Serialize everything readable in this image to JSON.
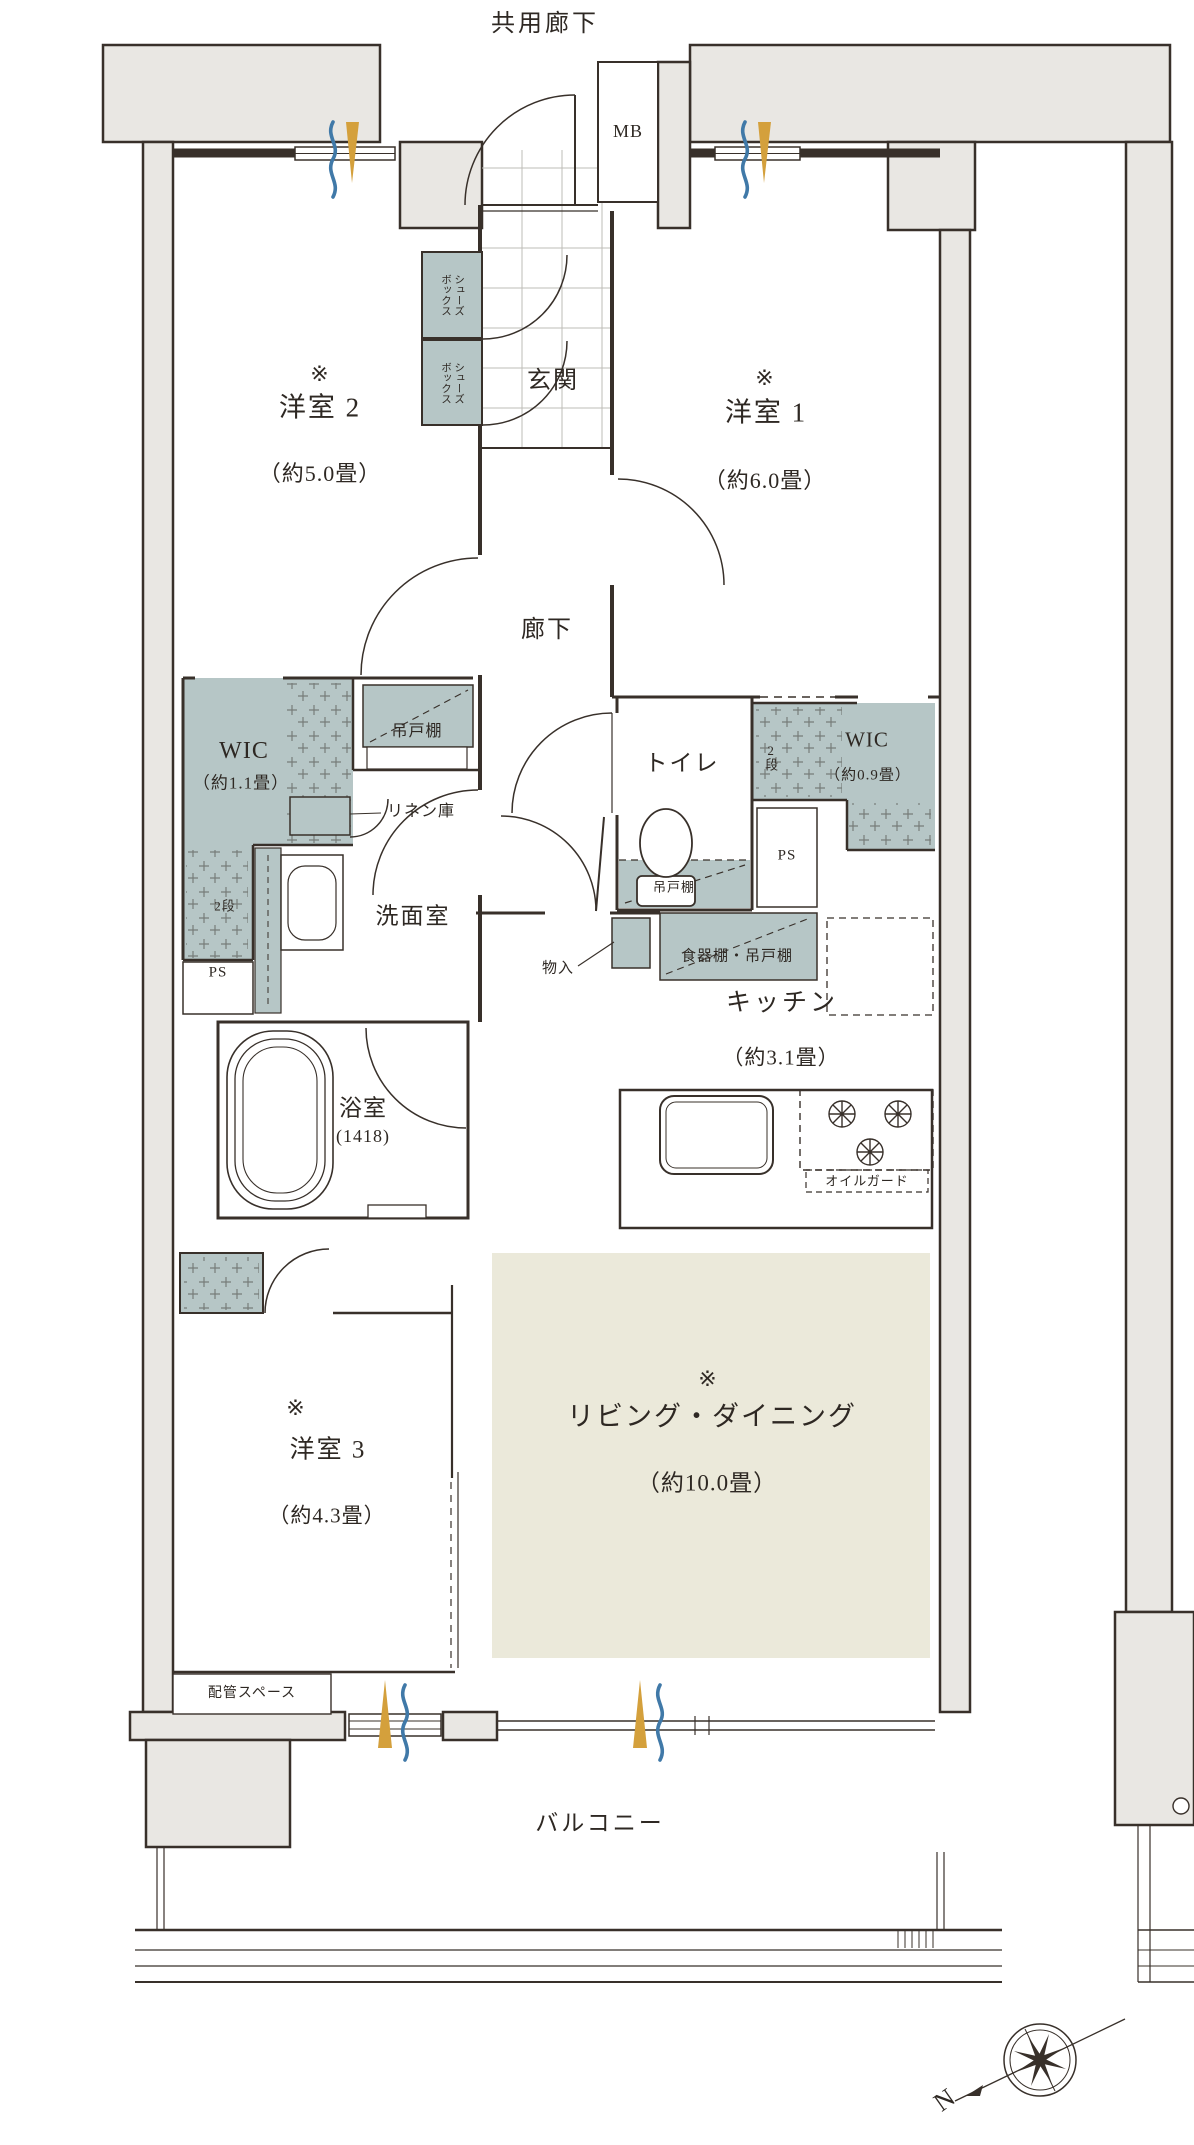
{
  "header": {
    "top_label": "共用廊下"
  },
  "rooms": {
    "yoshitsu2": {
      "mark": "※",
      "name": "洋室 2",
      "size": "（約5.0畳）"
    },
    "yoshitsu1": {
      "mark": "※",
      "name": "洋室 1",
      "size": "（約6.0畳）"
    },
    "yoshitsu3": {
      "mark": "※",
      "name": "洋室 3",
      "size": "（約4.3畳）"
    },
    "living": {
      "mark": "※",
      "name": "リビング・ダイニング",
      "size": "（約10.0畳）"
    },
    "kitchen": {
      "name": "キッチン",
      "size": "（約3.1畳）"
    },
    "genkan": {
      "name": "玄関"
    },
    "rouka": {
      "name": "廊下"
    },
    "toilet": {
      "name": "トイレ"
    },
    "senmen": {
      "name": "洗面室"
    },
    "bath": {
      "name": "浴室",
      "size": "(1418)"
    },
    "balcony": {
      "name": "バルコニー"
    },
    "wic_left": {
      "name": "WIC",
      "size": "（約1.1畳）"
    },
    "wic_right": {
      "name": "WIC",
      "size": "（約0.9畳）"
    }
  },
  "storage": {
    "shoes_line1": "シューズ",
    "shoes_line2": "ボックス",
    "tsuridana": "吊戸棚",
    "linen": "リネン庫",
    "nidan": "2段",
    "shokkidana": "食器棚・吊戸棚",
    "mononire": "物入",
    "ps": "PS",
    "mb": "MB",
    "oil_guard": "オイルガード",
    "haikan": "配管スペース"
  },
  "compass": {
    "north": "N"
  },
  "colors": {
    "wall_gray": "#e9e7e3",
    "storage_teal": "#b6c6c6",
    "ld_beige": "#ebe9da",
    "line": "#38302a",
    "vent_blue": "#4079a8",
    "vent_orange": "#d4a03c"
  }
}
